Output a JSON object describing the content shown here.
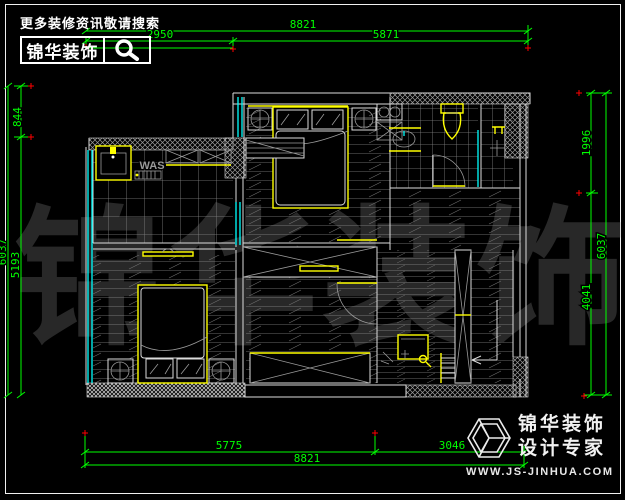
{
  "header": {
    "slogan": "更多装修资讯敬请搜索",
    "brand": "锦华装饰"
  },
  "dims": {
    "top": {
      "total": "8821",
      "seg1": "2950",
      "seg2": "5871"
    },
    "bottom": {
      "seg1": "5775",
      "seg2": "3046",
      "total": "8821"
    },
    "left": {
      "seg1": "844",
      "seg2": "5193",
      "total": "6037"
    },
    "right": {
      "seg1": "1996",
      "seg2": "4041",
      "total": "6037"
    }
  },
  "plan": {
    "washer_label": "WAS"
  },
  "watermark": {
    "text": "锦华装饰"
  },
  "footer": {
    "brand": "锦华装饰",
    "tagline": "设计专家",
    "website": "WWW.JS-JINHUA.COM"
  },
  "colors": {
    "dimension": "#00ff00",
    "window": "#00ffff",
    "furniture": "#ffff00",
    "marker": "#ff0000",
    "wallline": "#dcdcdc",
    "watermark": "#282828"
  }
}
